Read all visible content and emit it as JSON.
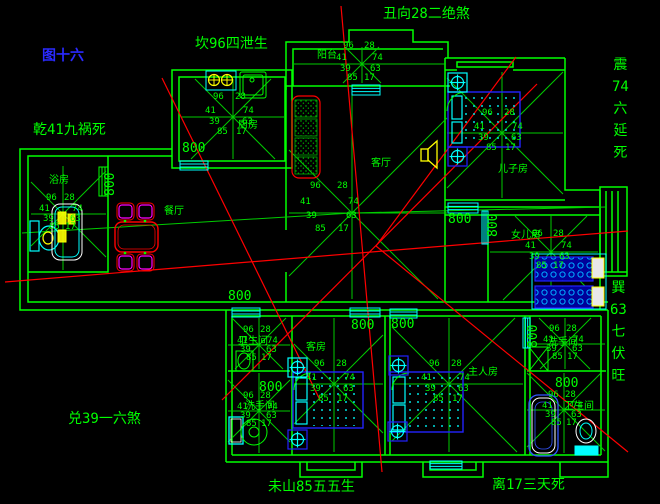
{
  "figure_label": "图十六",
  "annotations": {
    "top": "丑向28二绝煞",
    "top_left": "坎96四泄生",
    "left": "乾41九祸死",
    "right_upper": "震74六延死",
    "right_lower": "巽63七伏旺",
    "bottom_left": "兑39一六煞",
    "bottom_center": "未山85五五生",
    "bottom_right": "离17三天死"
  },
  "dimension_label": "800",
  "star_numbers": {
    "nw": "96",
    "ne": "28",
    "w": "41",
    "e": "74",
    "sw": "39",
    "se": "63",
    "s1": "85",
    "s2": "17"
  },
  "rooms": [
    {
      "id": "kitchen",
      "label": "厨房"
    },
    {
      "id": "balcony",
      "label": "阳台"
    },
    {
      "id": "living",
      "label": "客厅"
    },
    {
      "id": "dining",
      "label": "餐厅"
    },
    {
      "id": "bath-left",
      "label": "浴房"
    },
    {
      "id": "son-room",
      "label": "儿子房"
    },
    {
      "id": "daughter-room",
      "label": "女儿房"
    },
    {
      "id": "guest-room",
      "label": "客房"
    },
    {
      "id": "master-room",
      "label": "主人房"
    },
    {
      "id": "wc-1",
      "label": "卫生间"
    },
    {
      "id": "wc-2",
      "label": "洗手间"
    },
    {
      "id": "shower-room",
      "label": "洗手间"
    },
    {
      "id": "bath-br",
      "label": "卫生间"
    }
  ],
  "colors": {
    "background": "#000000",
    "wall_green": "#00ff00",
    "star_green": "#00cc00",
    "overlay_red": "#ff0000",
    "fixture_cyan": "#00ffff",
    "bed_blue": "#2222ff",
    "accent_yellow": "#ffff00",
    "chair_magenta": "#ff00ff",
    "figure_blue": "#2a2aff"
  }
}
